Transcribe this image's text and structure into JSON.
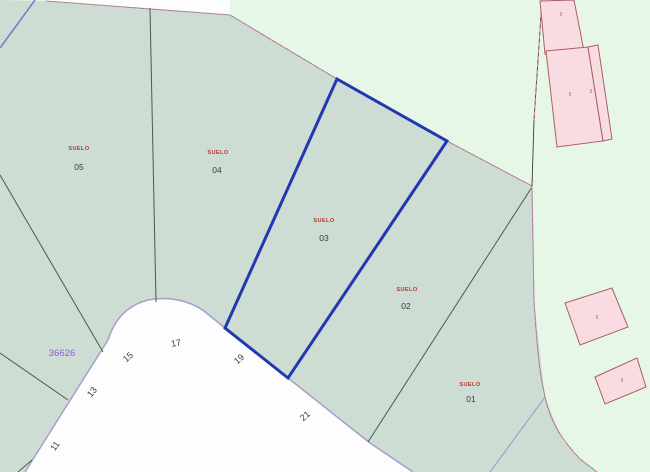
{
  "map_colors": {
    "urban_parcel_fill": "#cdddd4",
    "rural_fill": "#e6f7e8",
    "road_fill": "#fdfdfd",
    "selected_parcel_outline": "#2238b0",
    "boundary_line": "#4a5a50",
    "road_edge_line": "#a79dca",
    "purple_boundary": "#7e74c8",
    "dashed_overlay": "#d784a8",
    "building_fill": "#f9dce2",
    "building_stroke": "#a96065",
    "land_use_text": "#b23a2e",
    "parcel_number_text": "#3a3a3a",
    "reference_text": "#8d5fd0",
    "street_number_text": "#3d3d3d"
  },
  "parcels": [
    {
      "number": "05",
      "land_use": "SUELO"
    },
    {
      "number": "04",
      "land_use": "SUELO"
    },
    {
      "number": "03",
      "land_use": "SUELO"
    },
    {
      "number": "02",
      "land_use": "SUELO"
    },
    {
      "number": "01",
      "land_use": "SUELO"
    }
  ],
  "selected_parcel": "03",
  "reference_number": "36626",
  "street_numbers": [
    "11",
    "13",
    "15",
    "17",
    "19",
    "21"
  ],
  "buildings": [
    {
      "floors": "I"
    },
    {
      "floors": "I"
    },
    {
      "floors": "I"
    },
    {
      "floors": "I"
    },
    {
      "floors": "I"
    }
  ]
}
